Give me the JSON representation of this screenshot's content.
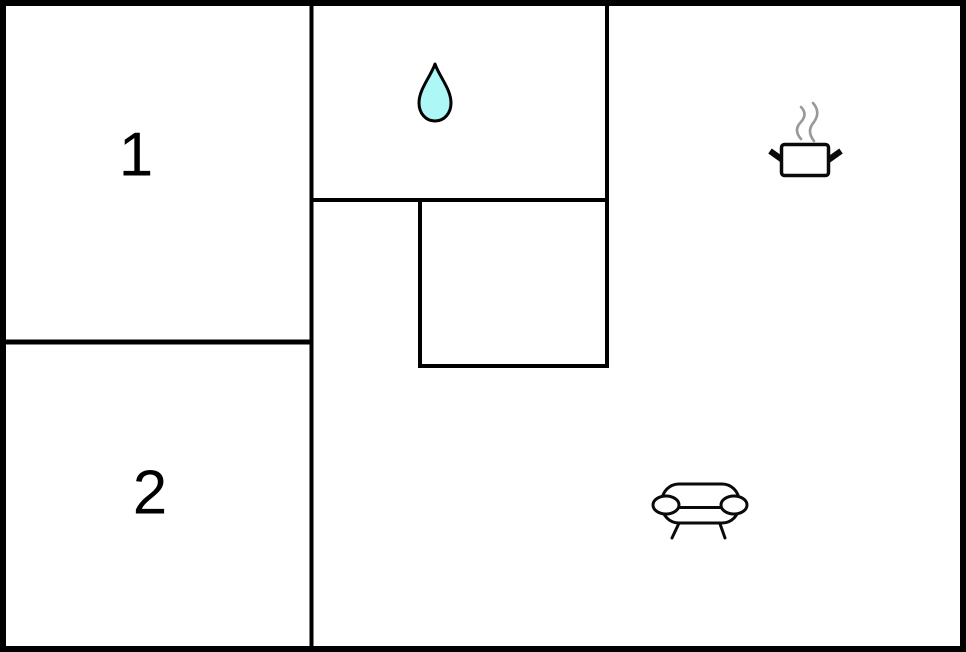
{
  "plan": {
    "type": "floor-plan",
    "rooms": {
      "room1": {
        "label": "1"
      },
      "room2": {
        "label": "2"
      },
      "bathroom": {
        "icon": "water-drop-icon"
      },
      "kitchen": {
        "icon": "cooking-pot-icon"
      },
      "living": {
        "icon": "sofa-icon"
      }
    },
    "icons": {
      "water_drop": "water-drop-icon",
      "cooking_pot": "cooking-pot-icon",
      "steam": "steam-icon",
      "sofa": "sofa-icon"
    },
    "colors": {
      "wall": "#000000",
      "background": "#ffffff",
      "drop_fill": "#aef7f7",
      "drop_stroke": "#000000",
      "steam": "#999999",
      "icon_stroke": "#0a0a0a",
      "label": "#000000"
    }
  }
}
